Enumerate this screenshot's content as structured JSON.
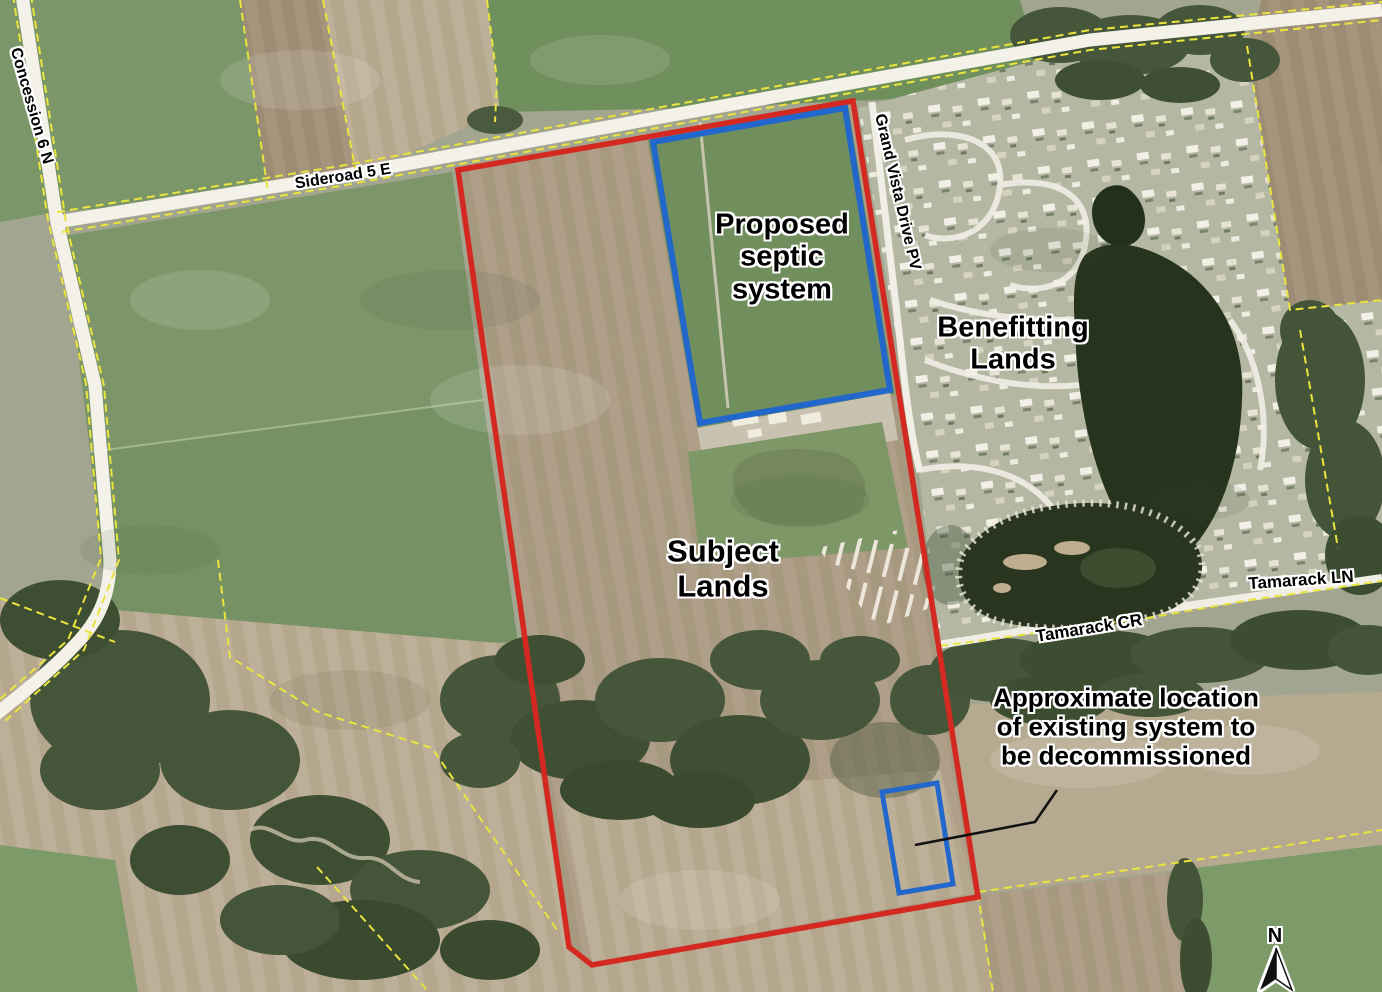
{
  "map": {
    "area_labels": {
      "proposed_septic": {
        "lines": [
          "Proposed",
          "septic",
          "system"
        ]
      },
      "benefitting_lands": {
        "lines": [
          "Benefitting",
          "Lands"
        ]
      },
      "subject_lands": {
        "lines": [
          "Subject",
          "Lands"
        ]
      },
      "decommission_note": {
        "lines": [
          "Approximate location",
          "of existing system to",
          "be decommissioned"
        ]
      }
    },
    "road_labels": {
      "concession_6_n": "Concession 6 N",
      "sideroad_5_e": "Sideroad 5 E",
      "grand_vista_drive": "Grand Vista Drive PV",
      "tamarack_ln": "Tamarack LN",
      "tamarack_cr": "Tamarack CR"
    },
    "north_arrow": {
      "label": "N"
    },
    "colors": {
      "subject_boundary_red": "#d42920",
      "septic_outline_blue": "#2267cb",
      "parcel_line_yellow": "#e9e43e",
      "road_white": "#f4f1e9",
      "label_text": "#000000",
      "label_halo": "#ffffff"
    }
  }
}
